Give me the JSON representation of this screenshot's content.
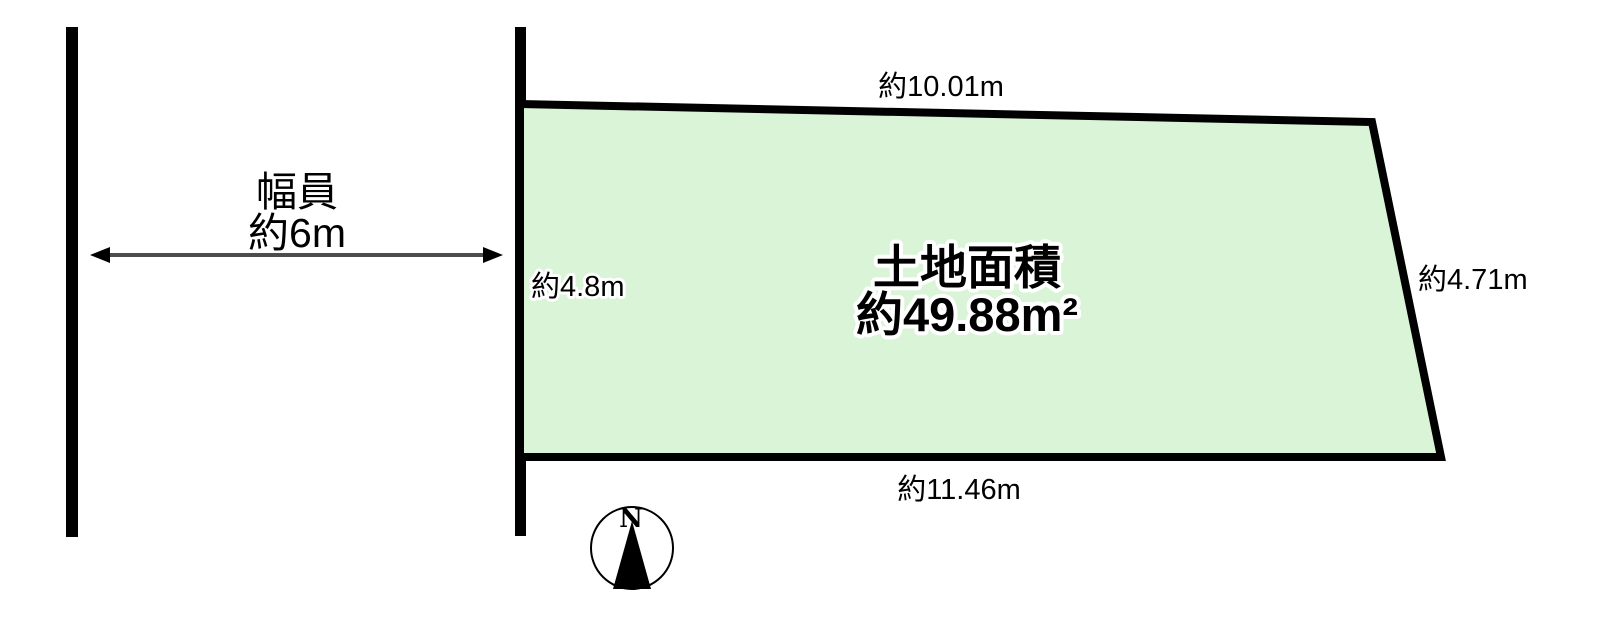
{
  "road": {
    "width_label_line1": "幅員",
    "width_label_line2": "約6m"
  },
  "plot": {
    "area_label_line1": "土地面積",
    "area_label_line2": "約49.88m²",
    "dimensions": {
      "top": "約10.01m",
      "left": "約4.8m",
      "right": "約4.71m",
      "bottom": "約11.46m"
    }
  },
  "compass": {
    "north_label": "N"
  },
  "colors": {
    "plot_fill": "#d9f4d7",
    "plot_outline": "#000000",
    "road_line": "#000000",
    "arrow_line": "#4d4d4d",
    "text": "#000000",
    "background": "#ffffff"
  }
}
